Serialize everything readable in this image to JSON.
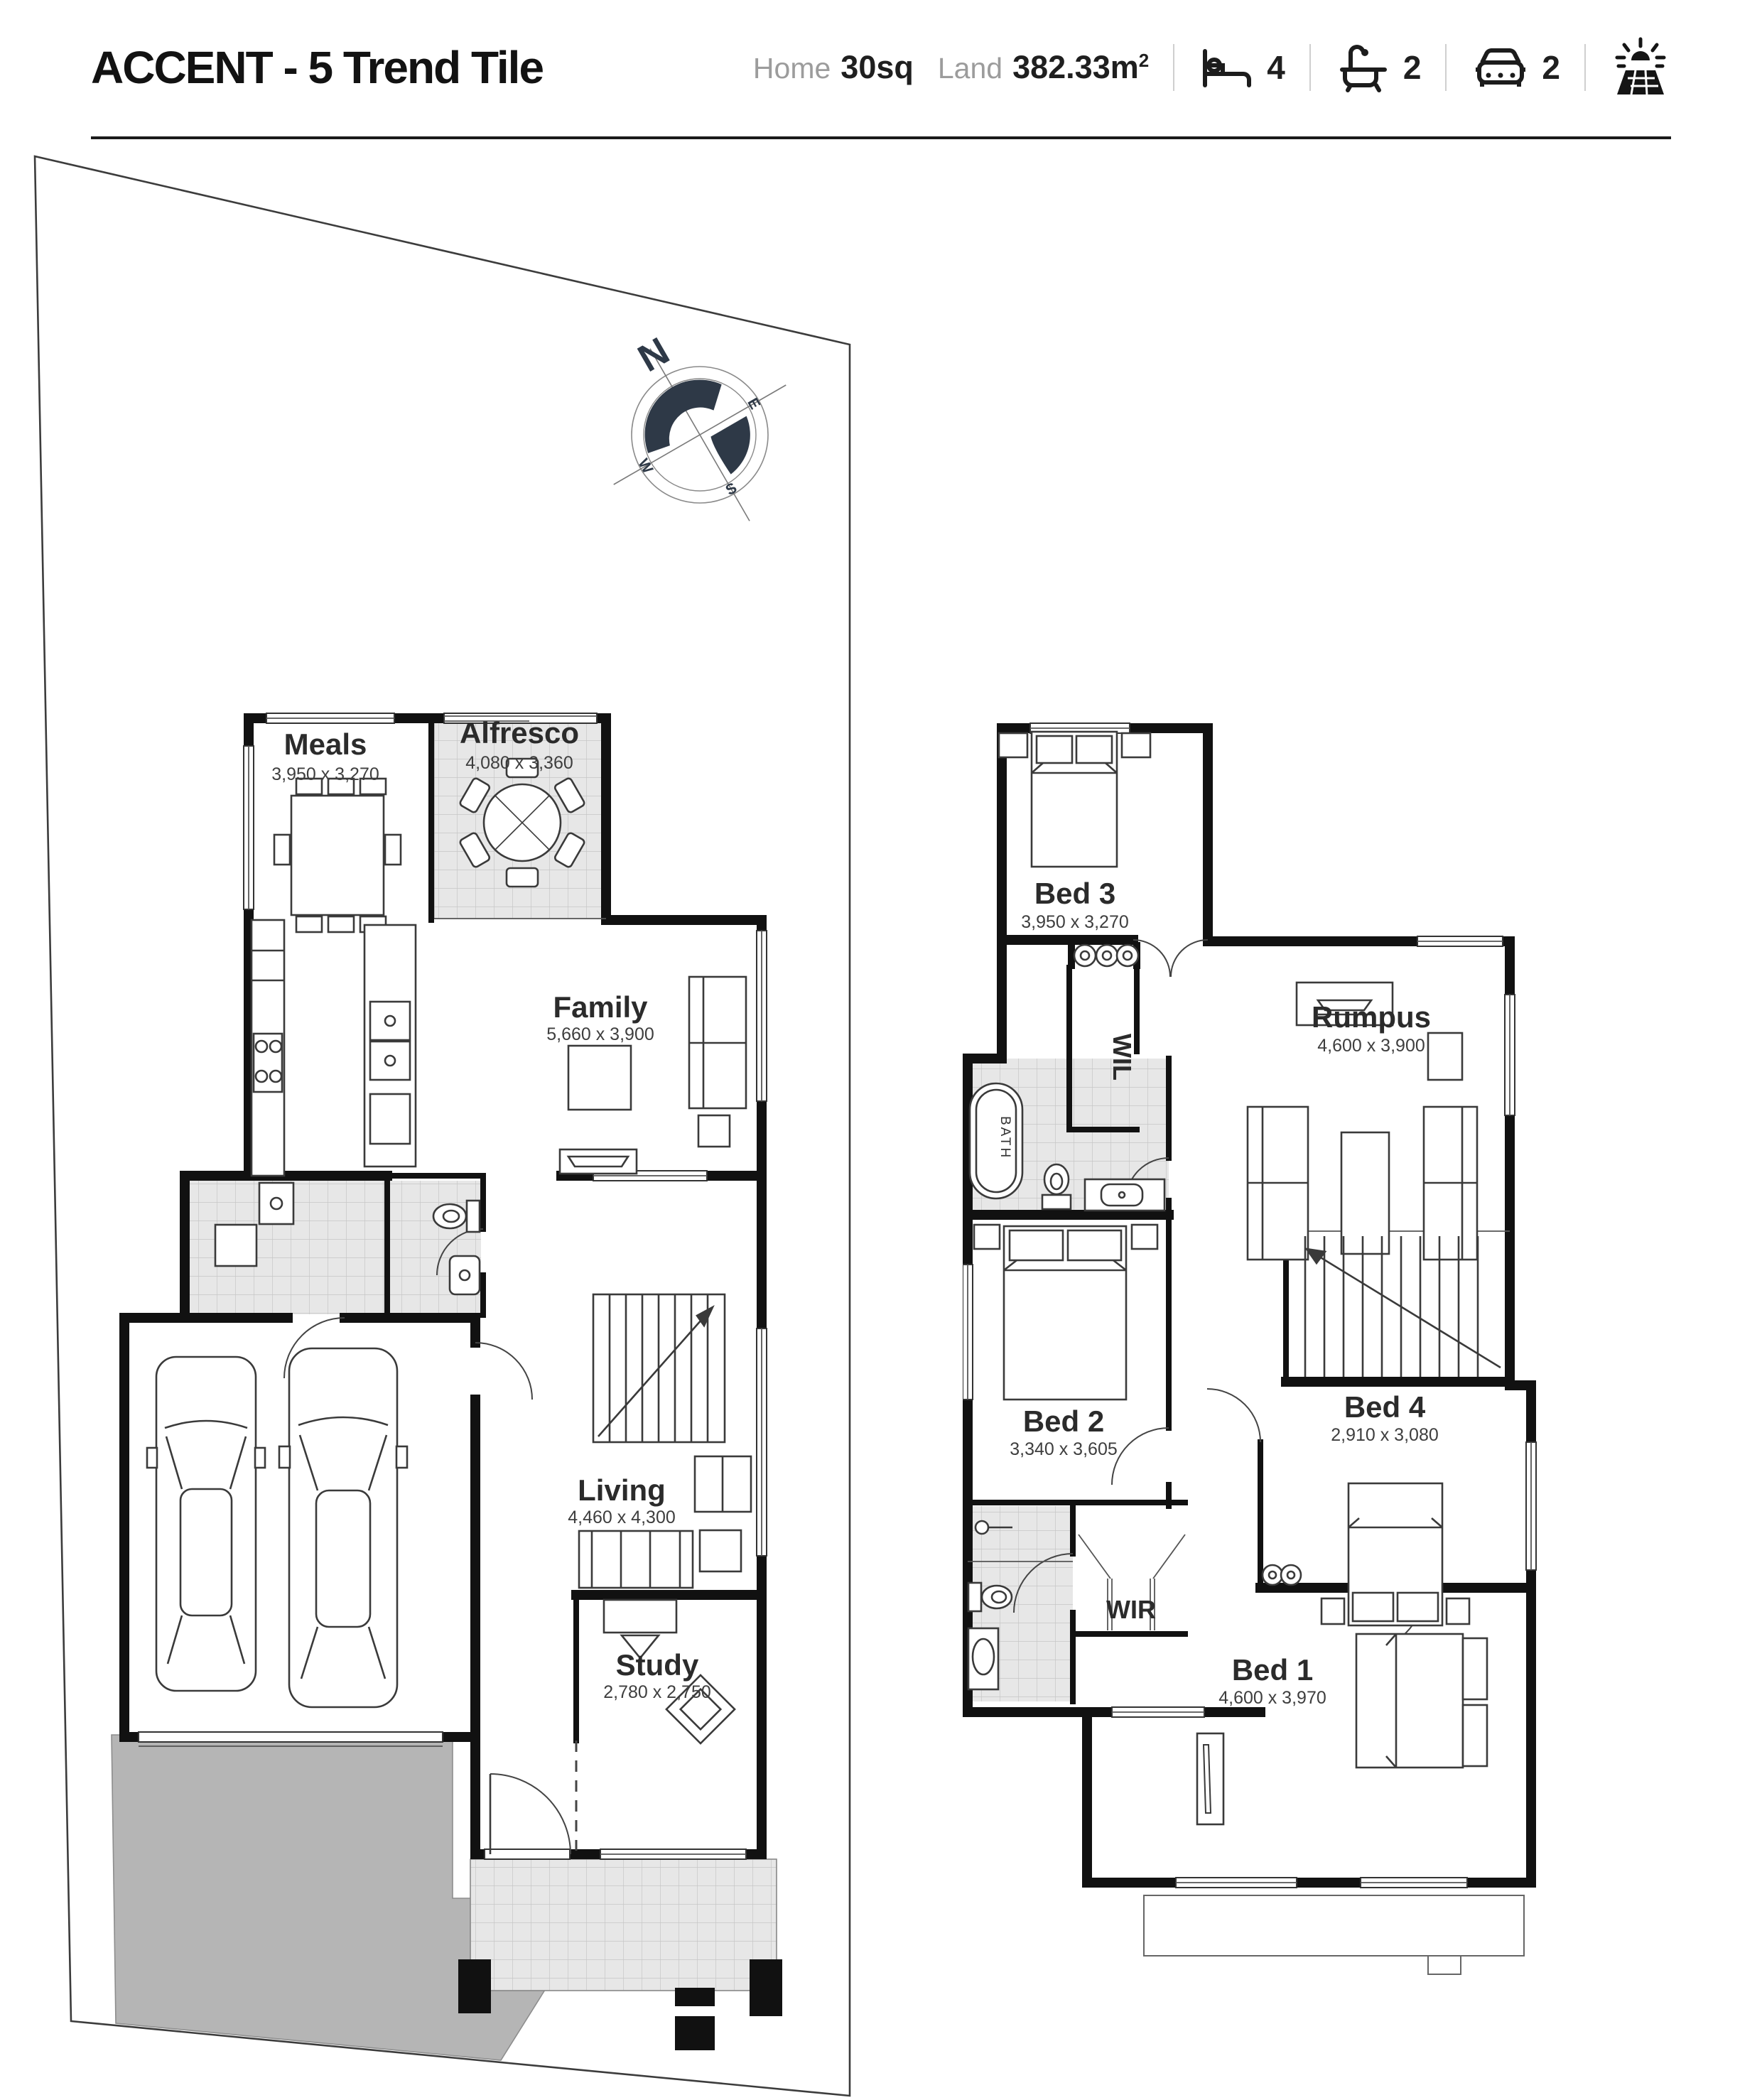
{
  "header": {
    "title": "ACCENT - 5 Trend Tile",
    "stats": {
      "home_label": "Home",
      "home_value": "30sq",
      "land_label": "Land",
      "land_value": "382.33m",
      "land_sup": "2",
      "beds": "4",
      "baths": "2",
      "cars": "2"
    }
  },
  "compass": {
    "north": "N",
    "east": "E",
    "south": "S",
    "west": "W"
  },
  "ground_floor": {
    "rooms": {
      "meals": {
        "name": "Meals",
        "dims": "3,950 x 3,270"
      },
      "alfresco": {
        "name": "Alfresco",
        "dims": "4,080 x 3,360"
      },
      "family": {
        "name": "Family",
        "dims": "5,660 x 3,900"
      },
      "living": {
        "name": "Living",
        "dims": "4,460 x 4,300"
      },
      "study": {
        "name": "Study",
        "dims": "2,780 x 2,750"
      }
    }
  },
  "first_floor": {
    "rooms": {
      "bed3": {
        "name": "Bed 3",
        "dims": "3,950 x 3,270"
      },
      "rumpus": {
        "name": "Rumpus",
        "dims": "4,600 x 3,900"
      },
      "bed2": {
        "name": "Bed 2",
        "dims": "3,340 x 3,605"
      },
      "bed4": {
        "name": "Bed 4",
        "dims": "2,910 x 3,080"
      },
      "bed1": {
        "name": "Bed 1",
        "dims": "4,600 x 3,970"
      },
      "wil": "WIL",
      "wir": "WIR",
      "bath": "BATH"
    }
  },
  "colors": {
    "wall": "#111111",
    "tile": "#e7e7e7",
    "tile_line": "#c6c6c6",
    "driveway": "#b5b5b5",
    "compass": "#2e3947",
    "muted_label": "#9c9c9c",
    "text": "#2b2b2b"
  }
}
